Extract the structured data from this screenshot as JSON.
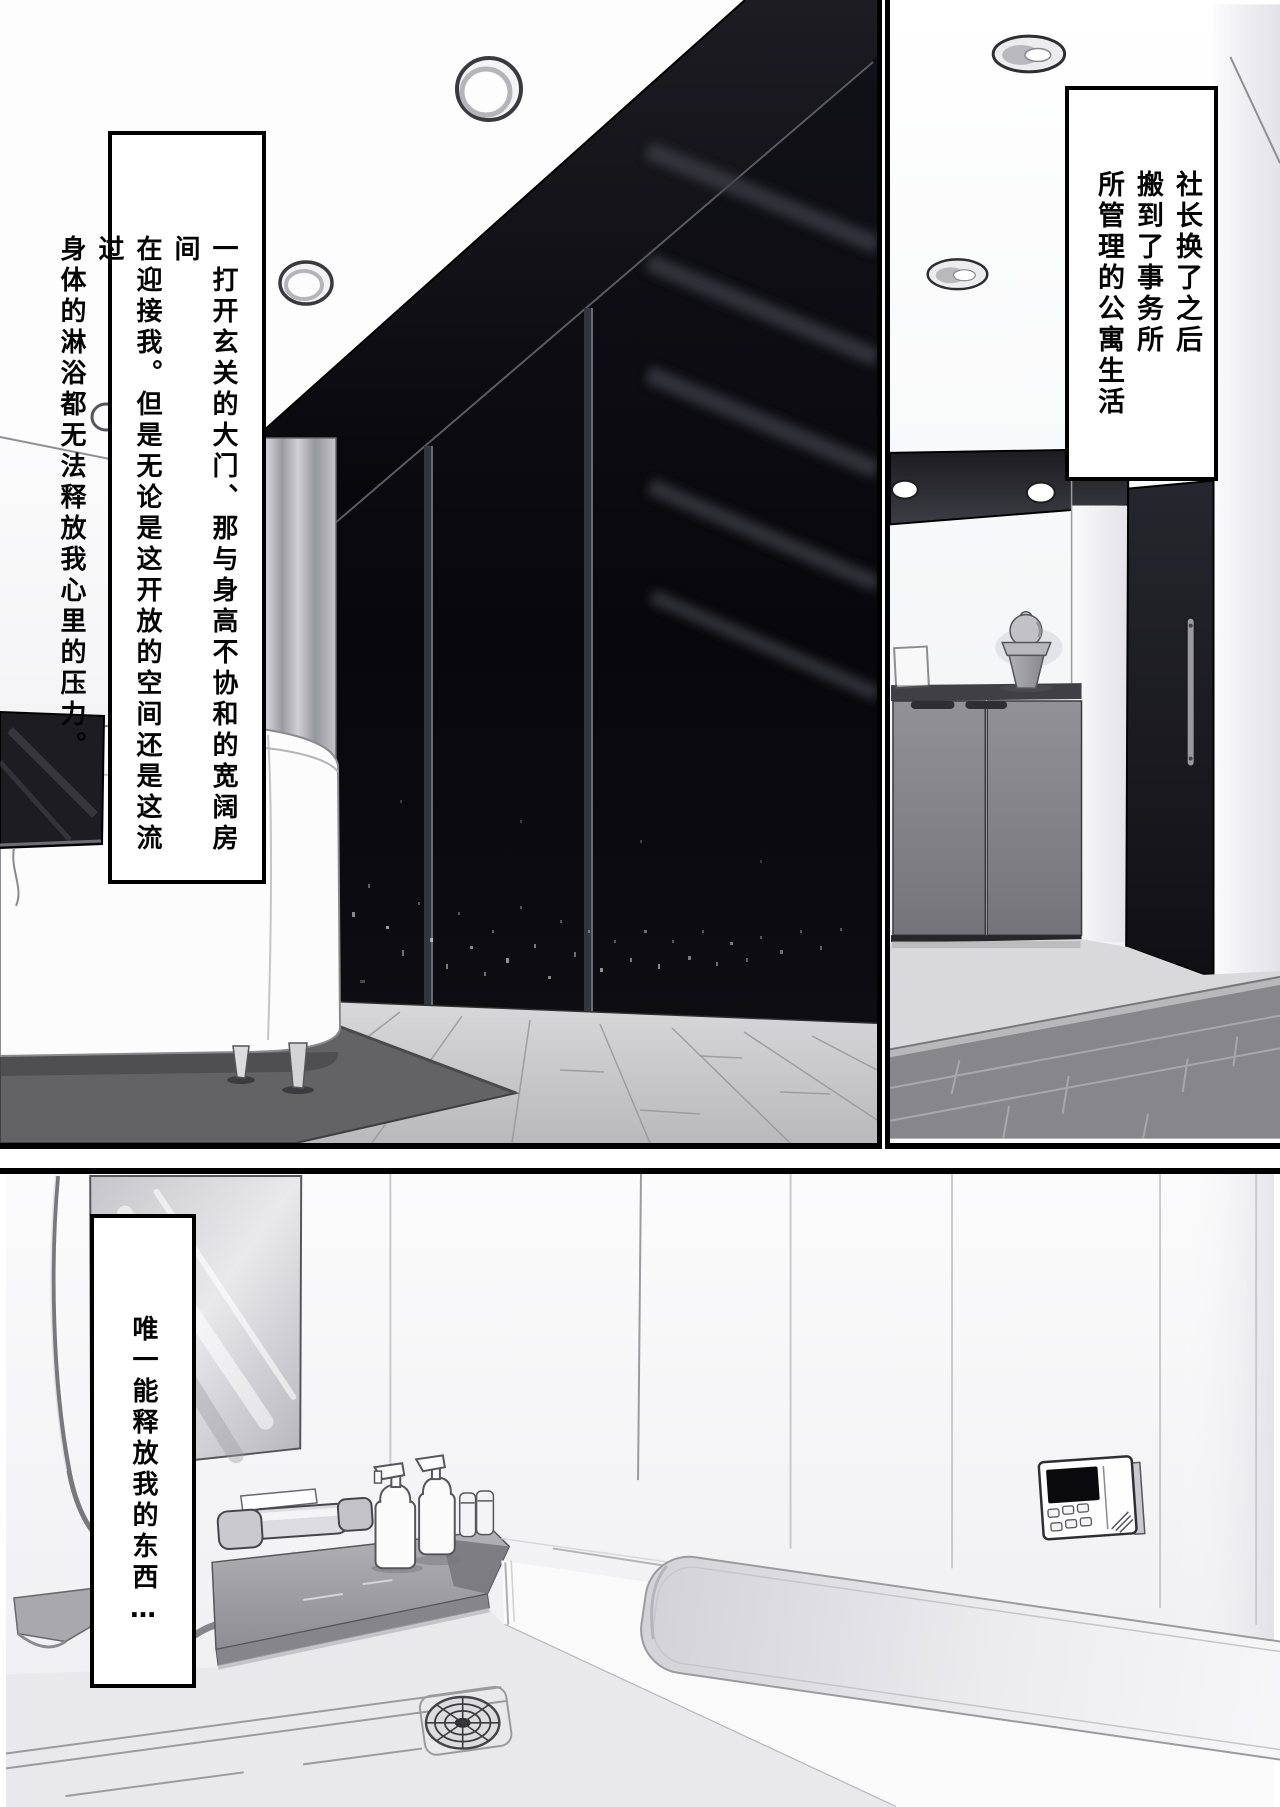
{
  "page": {
    "kind": "manga page",
    "language": "zh",
    "reading_direction": "right-to-left, vertical columns"
  },
  "palette": {
    "ink": "#000000",
    "paper": "#ffffff",
    "night_window": "#0b0b10",
    "beam": "#101016",
    "rug": "#636366",
    "wood_floor": "#c7c7c9",
    "cabinet": "#85858a",
    "entry_door": "#1d1d24",
    "entry_tile": "#87878b",
    "bath_wall": "#f4f4f6",
    "counter": "#a6a6aa"
  },
  "panels": [
    {
      "id": "living-room-night",
      "caption": {
        "columns": [
          "一打开玄关的大门、那与身高不协和的宽阔房间",
          "在迎接我。但是无论是这开放的空间还是这流过",
          "身体的淋浴都无法释放我心里的压力。"
        ]
      }
    },
    {
      "id": "entrance-hall",
      "caption": {
        "columns": [
          "社长换了之后",
          "搬到了事务所",
          "所管理的公寓生活"
        ]
      }
    },
    {
      "id": "bathroom",
      "caption": {
        "columns": [
          "唯一能释放我的东西…"
        ]
      }
    }
  ]
}
